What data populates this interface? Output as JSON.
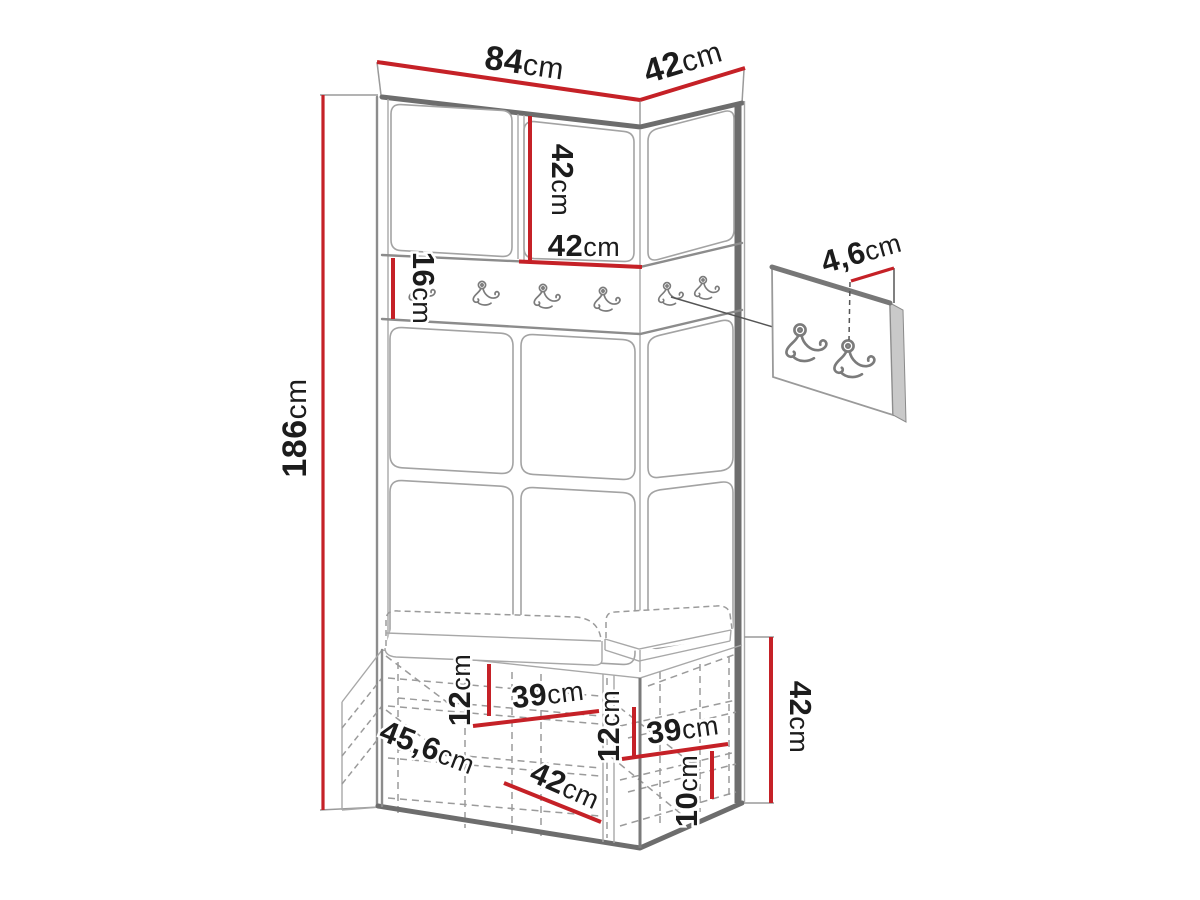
{
  "figure": {
    "type": "furniture-dimension-diagram",
    "subject": "corner hallway wardrobe with coat hook rail, upholstered wall panels and shoe bench",
    "units": "cm"
  },
  "colors": {
    "background": "#ffffff",
    "dimension_line": "#c52127",
    "outline_dark": "#6d6d6d",
    "outline": "#8c8c8c",
    "outline_light": "#a3a3a3",
    "text": "#1c1c1c"
  },
  "icons": {
    "coat_hook": "double-coat-hook-icon"
  },
  "dimensions": {
    "front_width": {
      "value": "84",
      "unit": "cm"
    },
    "side_width": {
      "value": "42",
      "unit": "cm"
    },
    "cabinet_height": {
      "value": "42",
      "unit": "cm"
    },
    "cabinet_width": {
      "value": "42",
      "unit": "cm"
    },
    "rail_height": {
      "value": "16",
      "unit": "cm"
    },
    "total_height": {
      "value": "186",
      "unit": "cm"
    },
    "hook_panel_dim": {
      "value": "4,6",
      "unit": "cm"
    },
    "left_shelf_spacing": {
      "value": "12",
      "unit": "cm"
    },
    "left_shelf_width": {
      "value": "39",
      "unit": "cm"
    },
    "bench_depth": {
      "value": "45,6",
      "unit": "cm"
    },
    "bench_opening_width": {
      "value": "42",
      "unit": "cm"
    },
    "right_shelf_spacing": {
      "value": "12",
      "unit": "cm"
    },
    "right_shelf_width": {
      "value": "39",
      "unit": "cm"
    },
    "bottom_gap": {
      "value": "10",
      "unit": "cm"
    },
    "bench_height": {
      "value": "42",
      "unit": "cm"
    }
  }
}
